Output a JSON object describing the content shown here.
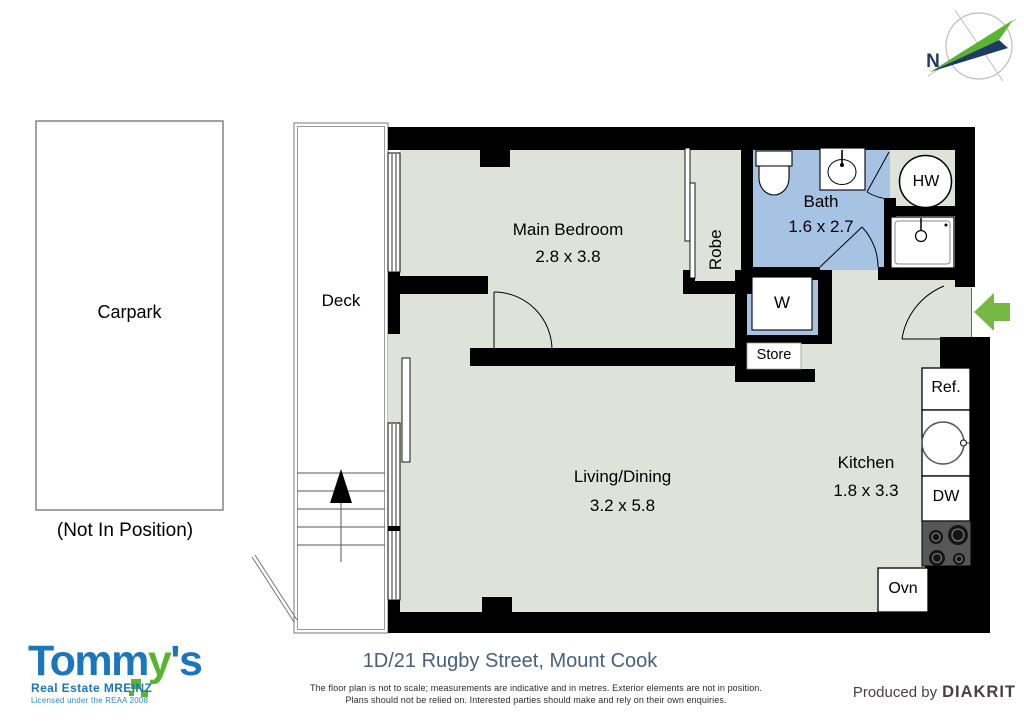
{
  "colors": {
    "room_fill": "#dde3d9",
    "bath_fill": "#a7c3e4",
    "wall": "#000000",
    "accent_green": "#76b843",
    "accent_navy": "#1e3c64",
    "brand_blue": "#1b76bc",
    "brand_green": "#59b531",
    "address_navy": "#46607d"
  },
  "compass": {
    "north_label": "N"
  },
  "exterior": {
    "carpark_label": "Carpark",
    "carpark_note": "(Not In Position)",
    "deck_label": "Deck"
  },
  "rooms": {
    "main_bedroom": {
      "name": "Main Bedroom",
      "dims": "2.8 x 3.8"
    },
    "robe": {
      "name": "Robe"
    },
    "bath": {
      "name": "Bath",
      "dims": "1.6 x 2.7"
    },
    "living_dining": {
      "name": "Living/Dining",
      "dims": "3.2 x 5.8"
    },
    "kitchen": {
      "name": "Kitchen",
      "dims": "1.8 x 3.3"
    }
  },
  "fixtures": {
    "hot_water": "HW",
    "washer": "W",
    "store": "Store",
    "fridge": "Ref.",
    "dishwasher": "DW",
    "oven": "Ovn"
  },
  "branding": {
    "brand_first": "Tomm",
    "brand_y": "y",
    "brand_suffix": "'s",
    "tagline": "Real Estate MREINZ",
    "license": "Licensed under the REAA 2008"
  },
  "footer": {
    "address": "1D/21 Rugby Street, Mount Cook",
    "disclaimer_line1": "The floor plan is not to scale; measurements are indicative and in metres. Exterior elements are not in position.",
    "disclaimer_line2": "Plans should not be relied on. Interested parties should make and rely on their own enquiries.",
    "produced_by": "Produced by",
    "producer": "DIAKRIT"
  }
}
